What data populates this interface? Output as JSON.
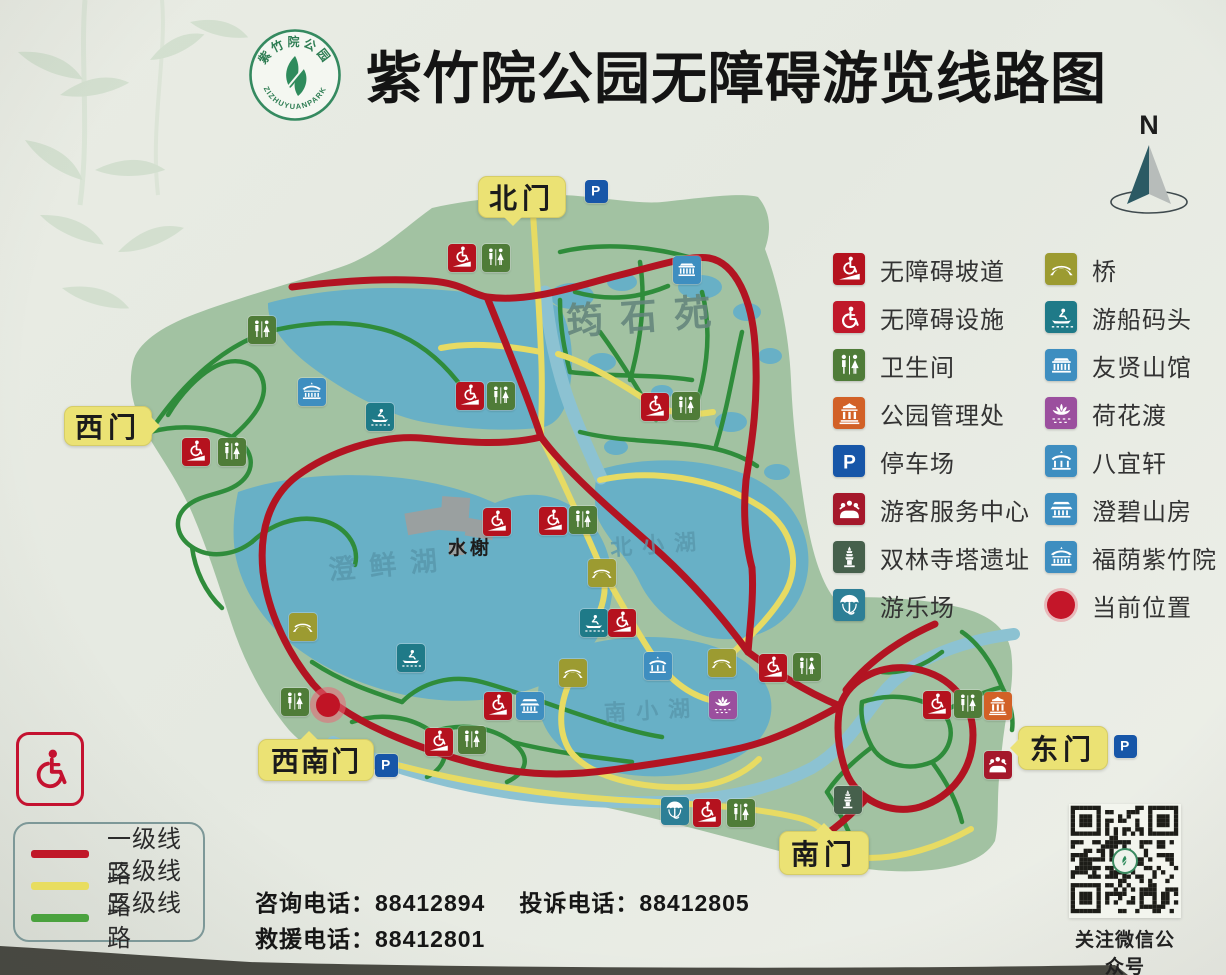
{
  "title": {
    "text": "紫竹院公园无障碍游览线路图"
  },
  "logo": {
    "top_text": "紫竹院公园",
    "bottom_text": "ZIZHUYUANPARK"
  },
  "compass": {
    "label": "N"
  },
  "glyphs": {
    "parking": "P"
  },
  "gates": [
    {
      "label": "北门"
    },
    {
      "label": "西门"
    },
    {
      "label": "西南门"
    },
    {
      "label": "南门"
    },
    {
      "label": "东门"
    }
  ],
  "map_labels": {
    "garden": "筠石苑",
    "main_lake": "澄鲜湖",
    "pavilion": "水榭",
    "north_lake": "北小湖",
    "south_lake": "南小湖"
  },
  "legend": {
    "column1": [
      {
        "icon": "ramp",
        "label": "无障碍坡道"
      },
      {
        "icon": "access",
        "label": "无障碍设施"
      },
      {
        "icon": "toilet",
        "label": "卫生间"
      },
      {
        "icon": "admin",
        "label": "公园管理处"
      },
      {
        "icon": "parking",
        "label": "停车场"
      },
      {
        "icon": "service",
        "label": "游客服务中心"
      },
      {
        "icon": "pagoda",
        "label": "双林寺塔遗址"
      },
      {
        "icon": "fun",
        "label": "游乐场"
      }
    ],
    "column2": [
      {
        "icon": "bridge",
        "label": "桥"
      },
      {
        "icon": "boat",
        "label": "游船码头"
      },
      {
        "icon": "hall",
        "label": "友贤山馆"
      },
      {
        "icon": "lotus",
        "label": "荷花渡"
      },
      {
        "icon": "pavilion",
        "label": "八宜轩"
      },
      {
        "icon": "shanfang",
        "label": "澄碧山房"
      },
      {
        "icon": "temple",
        "label": "福荫紫竹院"
      },
      {
        "icon": "current",
        "label": "当前位置"
      }
    ]
  },
  "icon_colors": {
    "ramp": "#b5121e",
    "access": "#c0182a",
    "toilet": "#4f7c38",
    "admin": "#d26127",
    "parking": "#1756a8",
    "service": "#a5182b",
    "pagoda": "#46604c",
    "fun": "#2d7f96",
    "bridge": "#9c9b31",
    "boat": "#1f7a88",
    "hall": "#3e8ec0",
    "lotus": "#9b4f9e",
    "pavilion": "#3e8ec0",
    "shanfang": "#3e8ec0",
    "temple": "#3e8ec0",
    "current": "#c41629"
  },
  "route_legend": [
    {
      "label": "一级线路",
      "color": "#c01828"
    },
    {
      "label": "二级线路",
      "color": "#e8dd60"
    },
    {
      "label": "三级线路",
      "color": "#4aa23e"
    }
  ],
  "contacts": {
    "row1": [
      {
        "label": "咨询电话：",
        "number": "88412894"
      },
      {
        "label": "投诉电话：",
        "number": "88412805"
      }
    ],
    "row2": [
      {
        "label": "救援电话：",
        "number": "88412801"
      }
    ]
  },
  "qr": {
    "caption": "关注微信公众号"
  },
  "pois": [
    {
      "t": "ramp",
      "x": 462,
      "y": 258
    },
    {
      "t": "toilet",
      "x": 496,
      "y": 258
    },
    {
      "t": "parking",
      "x": 596,
      "y": 191
    },
    {
      "t": "toilet",
      "x": 262,
      "y": 330
    },
    {
      "t": "temple",
      "x": 312,
      "y": 392
    },
    {
      "t": "boat",
      "x": 380,
      "y": 417
    },
    {
      "t": "ramp",
      "x": 196,
      "y": 452
    },
    {
      "t": "toilet",
      "x": 232,
      "y": 452
    },
    {
      "t": "ramp",
      "x": 470,
      "y": 396
    },
    {
      "t": "toilet",
      "x": 501,
      "y": 396
    },
    {
      "t": "hall",
      "x": 687,
      "y": 270
    },
    {
      "t": "ramp",
      "x": 655,
      "y": 407
    },
    {
      "t": "toilet",
      "x": 686,
      "y": 406
    },
    {
      "t": "ramp",
      "x": 497,
      "y": 522
    },
    {
      "t": "ramp",
      "x": 553,
      "y": 521
    },
    {
      "t": "toilet",
      "x": 583,
      "y": 520
    },
    {
      "t": "bridge",
      "x": 602,
      "y": 573
    },
    {
      "t": "boat",
      "x": 594,
      "y": 623
    },
    {
      "t": "ramp",
      "x": 622,
      "y": 623
    },
    {
      "t": "bridge",
      "x": 573,
      "y": 673
    },
    {
      "t": "pavilion",
      "x": 658,
      "y": 666
    },
    {
      "t": "bridge",
      "x": 722,
      "y": 663
    },
    {
      "t": "ramp",
      "x": 773,
      "y": 668
    },
    {
      "t": "toilet",
      "x": 807,
      "y": 667
    },
    {
      "t": "lotus",
      "x": 723,
      "y": 705
    },
    {
      "t": "ramp",
      "x": 498,
      "y": 706
    },
    {
      "t": "shanfang",
      "x": 530,
      "y": 706
    },
    {
      "t": "bridge",
      "x": 303,
      "y": 627
    },
    {
      "t": "boat",
      "x": 411,
      "y": 658
    },
    {
      "t": "toilet",
      "x": 295,
      "y": 702
    },
    {
      "t": "current",
      "x": 328,
      "y": 705
    },
    {
      "t": "parking",
      "x": 386,
      "y": 765
    },
    {
      "t": "ramp",
      "x": 439,
      "y": 742
    },
    {
      "t": "toilet",
      "x": 472,
      "y": 740
    },
    {
      "t": "fun",
      "x": 675,
      "y": 811
    },
    {
      "t": "ramp",
      "x": 707,
      "y": 813
    },
    {
      "t": "toilet",
      "x": 741,
      "y": 813
    },
    {
      "t": "pagoda",
      "x": 848,
      "y": 800
    },
    {
      "t": "ramp",
      "x": 937,
      "y": 705
    },
    {
      "t": "toilet",
      "x": 968,
      "y": 704
    },
    {
      "t": "admin",
      "x": 998,
      "y": 706
    },
    {
      "t": "service",
      "x": 998,
      "y": 765
    },
    {
      "t": "parking",
      "x": 1125,
      "y": 746
    }
  ]
}
